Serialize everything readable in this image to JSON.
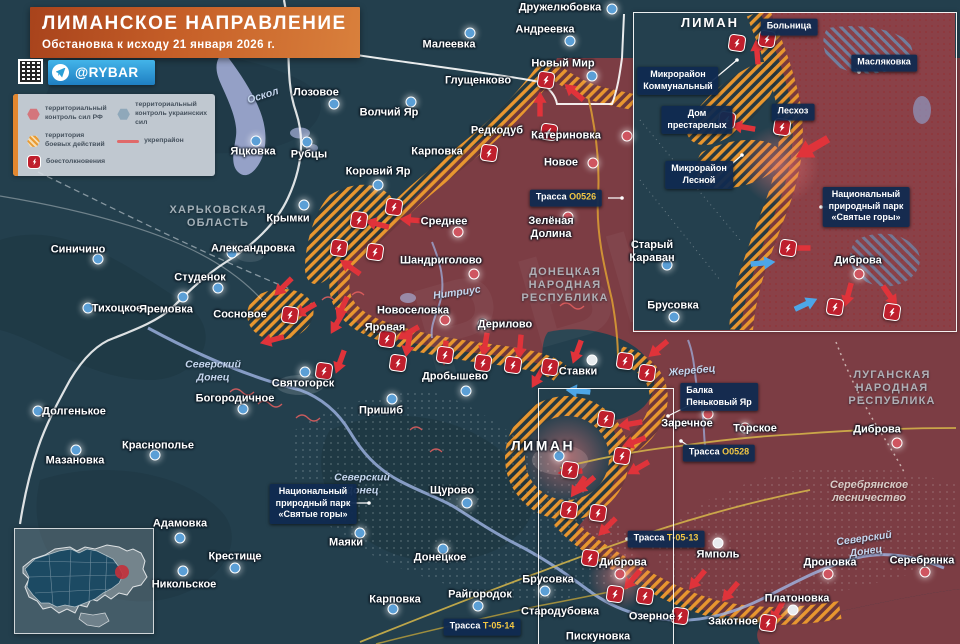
{
  "header": {
    "title": "ЛИМАНСКОЕ НАПРАВЛЕНИЕ",
    "subtitle": "Обстановка к исходу 21 января 2026 г.",
    "channel": "@RYBAR"
  },
  "legend": {
    "items": [
      {
        "key": "rf",
        "label": "территориальный контроль сил РФ"
      },
      {
        "key": "ua",
        "label": "территориальный контроль украинских сил"
      },
      {
        "key": "combat",
        "label": "территория боевых действий"
      },
      {
        "key": "fortline",
        "label": "укрепрайон"
      },
      {
        "key": "clash",
        "label": "боестолкновения"
      }
    ]
  },
  "colors": {
    "rf_zone": "#7c3d44",
    "ua_zone": "#233f4d",
    "combat_hatch": "#e8962f",
    "clash_badge": "#bf1f2d",
    "arrow_rf": "#e0333a",
    "arrow_ua": "#4da6e8",
    "water": "#a9b3dd",
    "callout_bg": "#102a50",
    "road_number": "#f2c744",
    "banner": "#c65f28",
    "telegram": "#2f9fd8"
  },
  "map": {
    "inset_title": {
      "t": "ЛИМАН",
      "l": [
        710,
        23
      ]
    },
    "towns": [
      {
        "n": "Дружелюбовка",
        "l": [
          560,
          8
        ],
        "m": [
          612,
          9
        ],
        "c": "ua"
      },
      {
        "n": "Андреевка",
        "l": [
          545,
          30
        ],
        "m": [
          570,
          41
        ],
        "c": "ua"
      },
      {
        "n": "Малеевка",
        "l": [
          449,
          45
        ],
        "m": [
          470,
          33
        ],
        "c": "ua"
      },
      {
        "n": "Новый Мир",
        "l": [
          563,
          64
        ],
        "m": [
          592,
          76
        ],
        "c": "ua"
      },
      {
        "n": "Глущенково",
        "l": [
          478,
          81
        ]
      },
      {
        "n": "Лозовое",
        "l": [
          316,
          93
        ],
        "m": [
          334,
          104
        ],
        "c": "ua"
      },
      {
        "n": "Волчий Яр",
        "l": [
          389,
          113
        ],
        "m": [
          411,
          102
        ],
        "c": "ua"
      },
      {
        "n": "Редкодуб",
        "l": [
          497,
          131
        ]
      },
      {
        "n": "Катериновка",
        "l": [
          566,
          136
        ],
        "m": [
          627,
          136
        ],
        "c": "rf"
      },
      {
        "n": "Карповка",
        "l": [
          437,
          152
        ]
      },
      {
        "n": "Новое",
        "l": [
          561,
          163
        ],
        "m": [
          593,
          163
        ],
        "c": "rf"
      },
      {
        "n": "Яцковка",
        "l": [
          253,
          152
        ],
        "m": [
          256,
          141
        ],
        "c": "ua"
      },
      {
        "n": "Рубцы",
        "l": [
          309,
          155
        ],
        "m": [
          307,
          142
        ],
        "c": "ua"
      },
      {
        "n": "Коровий Яр",
        "l": [
          378,
          172
        ],
        "m": [
          378,
          185
        ],
        "c": "ua"
      },
      {
        "n": "Крымки",
        "l": [
          288,
          219
        ],
        "m": [
          304,
          205
        ],
        "c": "ua"
      },
      {
        "n": "Александровка",
        "l": [
          253,
          249
        ],
        "m": [
          232,
          253
        ],
        "c": "ua"
      },
      {
        "n": "Синичино",
        "l": [
          78,
          250
        ],
        "m": [
          98,
          259
        ],
        "c": "ua"
      },
      {
        "n": "Студенок",
        "l": [
          200,
          278
        ],
        "m": [
          218,
          288
        ],
        "c": "ua"
      },
      {
        "n": "Тихоцкое",
        "l": [
          117,
          309
        ],
        "m": [
          88,
          308
        ],
        "c": "ua"
      },
      {
        "n": "Яремовка",
        "l": [
          166,
          310
        ],
        "m": [
          183,
          297
        ],
        "c": "ua"
      },
      {
        "n": "Сосновое",
        "l": [
          240,
          315
        ]
      },
      {
        "n": "Среднее",
        "l": [
          444,
          222
        ],
        "m": [
          458,
          232
        ],
        "c": "rf"
      },
      {
        "n": "Зелёная\nДолина",
        "l": [
          551,
          228
        ],
        "m": [
          568,
          217
        ],
        "c": "rf"
      },
      {
        "n": "Шандриголово",
        "l": [
          441,
          261
        ],
        "m": [
          474,
          274
        ],
        "c": "rf"
      },
      {
        "n": "Новоселовка",
        "l": [
          413,
          311
        ],
        "m": [
          445,
          320
        ],
        "c": "rf"
      },
      {
        "n": "Дерилово",
        "l": [
          505,
          325
        ],
        "m": [
          483,
          324
        ],
        "c": "rf"
      },
      {
        "n": "Яровая",
        "l": [
          385,
          328
        ]
      },
      {
        "n": "Святогорск",
        "l": [
          303,
          384
        ],
        "m": [
          305,
          372
        ],
        "c": "ua"
      },
      {
        "n": "Богородичное",
        "l": [
          235,
          399
        ],
        "m": [
          243,
          409
        ],
        "c": "ua"
      },
      {
        "n": "Долгенькое",
        "l": [
          74,
          412
        ],
        "m": [
          38,
          411
        ],
        "c": "ua"
      },
      {
        "n": "Краснополье",
        "l": [
          158,
          446
        ],
        "m": [
          155,
          455
        ],
        "c": "ua"
      },
      {
        "n": "Мазановка",
        "l": [
          75,
          461
        ],
        "m": [
          76,
          450
        ],
        "c": "ua"
      },
      {
        "n": "Пришиб",
        "l": [
          381,
          411
        ],
        "m": [
          392,
          399
        ],
        "c": "ua"
      },
      {
        "n": "Дробышево",
        "l": [
          455,
          377
        ],
        "m": [
          466,
          391
        ],
        "c": "ua"
      },
      {
        "n": "Ставки",
        "l": [
          578,
          372
        ],
        "m": [
          592,
          360
        ],
        "c": "wt"
      },
      {
        "n": "ЛИМАН",
        "l": [
          543,
          446
        ],
        "m": [
          559,
          456
        ],
        "c": "ua",
        "big": true
      },
      {
        "n": "Щурово",
        "l": [
          452,
          491
        ],
        "m": [
          467,
          503
        ],
        "c": "ua"
      },
      {
        "n": "Маяки",
        "l": [
          346,
          543
        ],
        "m": [
          360,
          533
        ],
        "c": "ua"
      },
      {
        "n": "Донецкое",
        "l": [
          440,
          558
        ],
        "m": [
          443,
          549
        ],
        "c": "ua"
      },
      {
        "n": "Карповка",
        "l": [
          395,
          600
        ],
        "m": [
          393,
          609
        ],
        "c": "ua"
      },
      {
        "n": "Райгородок",
        "l": [
          480,
          595
        ],
        "m": [
          478,
          606
        ],
        "c": "ua"
      },
      {
        "n": "Брусовка",
        "l": [
          548,
          580
        ],
        "m": [
          545,
          591
        ],
        "c": "ua"
      },
      {
        "n": "Стародубовка",
        "l": [
          560,
          612
        ]
      },
      {
        "n": "Пискуновка",
        "l": [
          598,
          637
        ]
      },
      {
        "n": "Адамовка",
        "l": [
          180,
          524
        ],
        "m": [
          180,
          538
        ],
        "c": "ua"
      },
      {
        "n": "Крестище",
        "l": [
          235,
          557
        ],
        "m": [
          235,
          568
        ],
        "c": "ua"
      },
      {
        "n": "Никольское",
        "l": [
          184,
          585
        ],
        "m": [
          183,
          571
        ],
        "c": "ua"
      },
      {
        "n": "Заречное",
        "l": [
          687,
          424
        ],
        "m": [
          708,
          414
        ],
        "c": "rf"
      },
      {
        "n": "Торское",
        "l": [
          755,
          429
        ],
        "m": [
          745,
          428
        ],
        "c": "rf"
      },
      {
        "n": "Диброва",
        "l": [
          877,
          430
        ],
        "m": [
          897,
          443
        ],
        "c": "rf"
      },
      {
        "n": "Диброва",
        "l": [
          623,
          563
        ],
        "m": [
          620,
          574
        ],
        "c": "rf"
      },
      {
        "n": "Озерное",
        "l": [
          652,
          617
        ]
      },
      {
        "n": "Закотное",
        "l": [
          733,
          622
        ]
      },
      {
        "n": "Ямполь",
        "l": [
          718,
          555
        ],
        "m": [
          718,
          543
        ],
        "c": "wt"
      },
      {
        "n": "Платоновка",
        "l": [
          797,
          599
        ],
        "m": [
          793,
          610
        ],
        "c": "wt"
      },
      {
        "n": "Дроновка",
        "l": [
          830,
          563
        ],
        "m": [
          828,
          574
        ],
        "c": "rf"
      },
      {
        "n": "Серебрянка",
        "l": [
          922,
          561
        ],
        "m": [
          925,
          572
        ],
        "c": "rf"
      },
      {
        "n": "Старый\nКараван",
        "l": [
          652,
          252
        ],
        "m": [
          667,
          265
        ],
        "c": "ua"
      },
      {
        "n": "Брусовка",
        "l": [
          673,
          306
        ],
        "m": [
          674,
          317
        ],
        "c": "ua"
      },
      {
        "n": "Диброва",
        "l": [
          858,
          261
        ],
        "m": [
          859,
          274
        ],
        "c": "rf"
      }
    ],
    "regions": [
      {
        "n": "ХАРЬКОВСКАЯ\nОБЛАСТЬ",
        "l": [
          218,
          217
        ]
      },
      {
        "n": "ДОНЕЦКАЯ\nНАРОДНАЯ\nРЕСПУБЛИКА",
        "l": [
          565,
          286
        ]
      },
      {
        "n": "ЛУГАНСКАЯ\nНАРОДНАЯ\nРЕСПУБЛИКА",
        "l": [
          892,
          389
        ]
      }
    ],
    "rivers": [
      {
        "n": "Оскол",
        "l": [
          263,
          96
        ],
        "r": -18
      },
      {
        "n": "Северский\nДонец",
        "l": [
          213,
          371
        ]
      },
      {
        "n": "Нитриус",
        "l": [
          457,
          293
        ],
        "r": -8
      },
      {
        "n": "Северский\nДонец",
        "l": [
          362,
          484
        ]
      },
      {
        "n": "Жеребец",
        "l": [
          692,
          371
        ],
        "r": -5
      },
      {
        "n": "Северский\nДонец",
        "l": [
          865,
          545
        ],
        "r": -8
      }
    ],
    "forests": [
      {
        "n": "Серебрянское\nлесничество",
        "l": [
          869,
          492
        ]
      }
    ],
    "callouts": [
      {
        "t": "Больница",
        "l": [
          789,
          27
        ]
      },
      {
        "t": "Масляковка",
        "l": [
          884,
          63
        ]
      },
      {
        "t": "Микрорайон\nКоммунальный",
        "l": [
          678,
          81
        ]
      },
      {
        "t": "Дом\nпрестарелых",
        "l": [
          697,
          120
        ]
      },
      {
        "t": "Лесхоз",
        "l": [
          793,
          112
        ]
      },
      {
        "t": "Микрорайон\nЛесной",
        "l": [
          699,
          175
        ]
      },
      {
        "t": "Национальный\nприродный парк\n«Святые горы»",
        "l": [
          866,
          207
        ]
      },
      {
        "t": "Национальный\nприродный парк\n«Святые горы»",
        "l": [
          313,
          504
        ]
      },
      {
        "t": "Балка\nПеньковый Яр",
        "l": [
          719,
          397
        ],
        "align": "left"
      },
      {
        "pre": "Трасса ",
        "num": "О0526",
        "l": [
          566,
          198
        ]
      },
      {
        "pre": "Трасса ",
        "num": "О0528",
        "l": [
          719,
          453
        ]
      },
      {
        "pre": "Трасса ",
        "num": "Т-05-13",
        "l": [
          666,
          539
        ]
      },
      {
        "pre": "Трасса ",
        "num": "Т-05-14",
        "l": [
          482,
          627
        ]
      }
    ],
    "clashes": [
      [
        546,
        80
      ],
      [
        549,
        132
      ],
      [
        489,
        153
      ],
      [
        394,
        207
      ],
      [
        359,
        220
      ],
      [
        339,
        248
      ],
      [
        375,
        252
      ],
      [
        290,
        315
      ],
      [
        387,
        339
      ],
      [
        324,
        371
      ],
      [
        398,
        363
      ],
      [
        445,
        355
      ],
      [
        483,
        363
      ],
      [
        513,
        365
      ],
      [
        550,
        367
      ],
      [
        625,
        361
      ],
      [
        647,
        373
      ],
      [
        606,
        419
      ],
      [
        622,
        456
      ],
      [
        570,
        470
      ],
      [
        569,
        510
      ],
      [
        598,
        513
      ],
      [
        590,
        558
      ],
      [
        615,
        594
      ],
      [
        645,
        596
      ],
      [
        680,
        616
      ],
      [
        768,
        623
      ],
      [
        737,
        43
      ],
      [
        767,
        39
      ],
      [
        727,
        120
      ],
      [
        782,
        127
      ],
      [
        788,
        248
      ],
      [
        835,
        307
      ],
      [
        892,
        312
      ]
    ],
    "arrows": [
      {
        "x": 540,
        "y": 104,
        "r": -90
      },
      {
        "x": 574,
        "y": 92,
        "r": -140
      },
      {
        "x": 412,
        "y": 220,
        "r": 185
      },
      {
        "x": 377,
        "y": 224,
        "r": 195
      },
      {
        "x": 350,
        "y": 267,
        "r": 215
      },
      {
        "x": 342,
        "y": 308,
        "r": 115
      },
      {
        "x": 408,
        "y": 333,
        "r": 150
      },
      {
        "x": 283,
        "y": 287,
        "r": 135
      },
      {
        "x": 305,
        "y": 310,
        "r": 150
      },
      {
        "x": 272,
        "y": 340,
        "r": 165
      },
      {
        "x": 337,
        "y": 323,
        "r": 120
      },
      {
        "x": 340,
        "y": 362,
        "r": 110
      },
      {
        "x": 408,
        "y": 345,
        "r": 100
      },
      {
        "x": 445,
        "y": 353,
        "r": 95
      },
      {
        "x": 485,
        "y": 345,
        "r": 100
      },
      {
        "x": 520,
        "y": 347,
        "r": 95
      },
      {
        "x": 577,
        "y": 352,
        "r": 110
      },
      {
        "x": 538,
        "y": 377,
        "r": 120
      },
      {
        "x": 658,
        "y": 349,
        "r": 140
      },
      {
        "x": 630,
        "y": 424,
        "r": 170
      },
      {
        "x": 634,
        "y": 442,
        "r": 160
      },
      {
        "x": 638,
        "y": 468,
        "r": 150
      },
      {
        "x": 570,
        "y": 472,
        "r": 175
      },
      {
        "x": 585,
        "y": 485,
        "r": 140
      },
      {
        "x": 607,
        "y": 527,
        "r": 135
      },
      {
        "x": 578,
        "y": 487,
        "r": 125
      },
      {
        "x": 632,
        "y": 580,
        "r": 130
      },
      {
        "x": 697,
        "y": 580,
        "r": 130
      },
      {
        "x": 730,
        "y": 592,
        "r": 130
      },
      {
        "x": 777,
        "y": 612,
        "r": 120
      },
      {
        "x": 757,
        "y": 52,
        "r": -95
      },
      {
        "x": 743,
        "y": 127,
        "r": 190
      },
      {
        "x": 812,
        "y": 148,
        "r": 150,
        "s": 1.5
      },
      {
        "x": 798,
        "y": 248,
        "r": 180
      },
      {
        "x": 848,
        "y": 295,
        "r": 105
      },
      {
        "x": 890,
        "y": 296,
        "r": 55
      },
      {
        "x": 578,
        "y": 391,
        "r": 185,
        "c": "ua"
      },
      {
        "x": 763,
        "y": 263,
        "r": -5,
        "c": "ua"
      },
      {
        "x": 806,
        "y": 304,
        "r": -25,
        "c": "ua"
      }
    ],
    "leaders": [
      [
        608,
        198,
        622,
        198
      ],
      [
        690,
        447,
        681,
        441
      ],
      [
        634,
        539,
        627,
        539
      ],
      [
        344,
        503,
        369,
        503
      ],
      [
        833,
        207,
        821,
        207
      ],
      [
        692,
        404,
        668,
        416
      ],
      [
        773,
        33,
        766,
        41
      ],
      [
        856,
        68,
        859,
        72
      ],
      [
        706,
        86,
        737,
        60
      ],
      [
        722,
        120,
        734,
        120
      ],
      [
        790,
        119,
        789,
        133
      ],
      [
        725,
        170,
        742,
        155
      ]
    ],
    "frames": {
      "inset": [
        633,
        12,
        322,
        318
      ],
      "source": [
        538,
        388,
        134,
        256
      ]
    }
  }
}
